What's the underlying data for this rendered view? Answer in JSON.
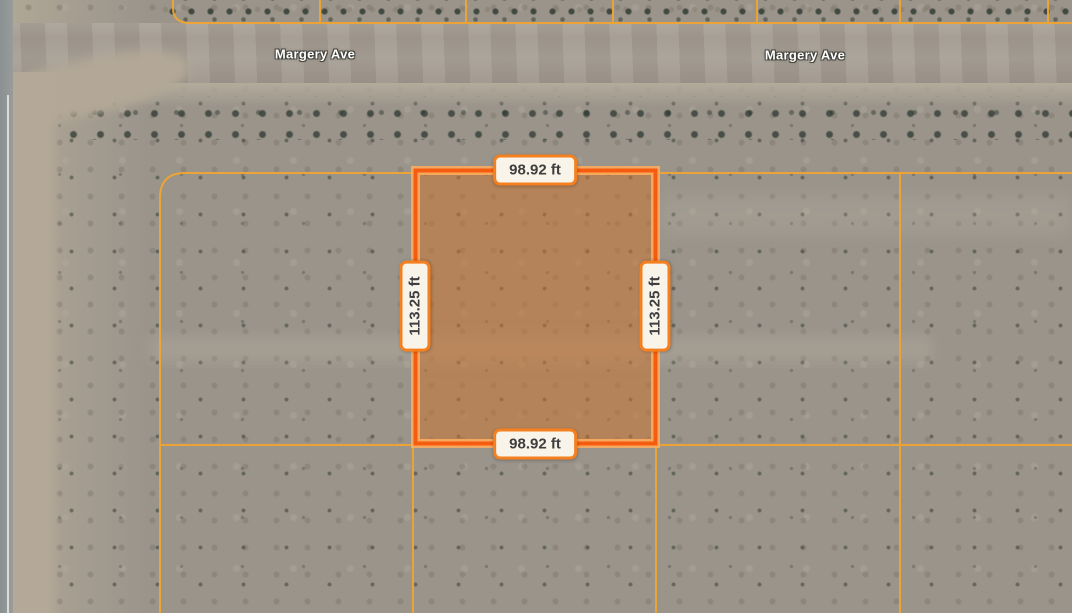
{
  "map": {
    "view": "satellite-parcel-view",
    "street_labels": [
      {
        "text": "Margery Ave"
      },
      {
        "text": "Margery Ave"
      }
    ],
    "parcel": {
      "dim_top": "98.92 ft",
      "dim_bottom": "98.92 ft",
      "dim_left": "113.25 ft",
      "dim_right": "113.25 ft"
    },
    "colors": {
      "parcel_outline": "#f65c0f",
      "parcel_outline_halo": "#ffae5e",
      "parcel_fill_tint": "#cd732d",
      "grid_line": "#f0a432",
      "dim_label_bg": "#f8f4ea",
      "dim_label_border": "#f58020",
      "dim_label_text": "#3e3e3e",
      "street_label_text": "#ffffff"
    }
  }
}
